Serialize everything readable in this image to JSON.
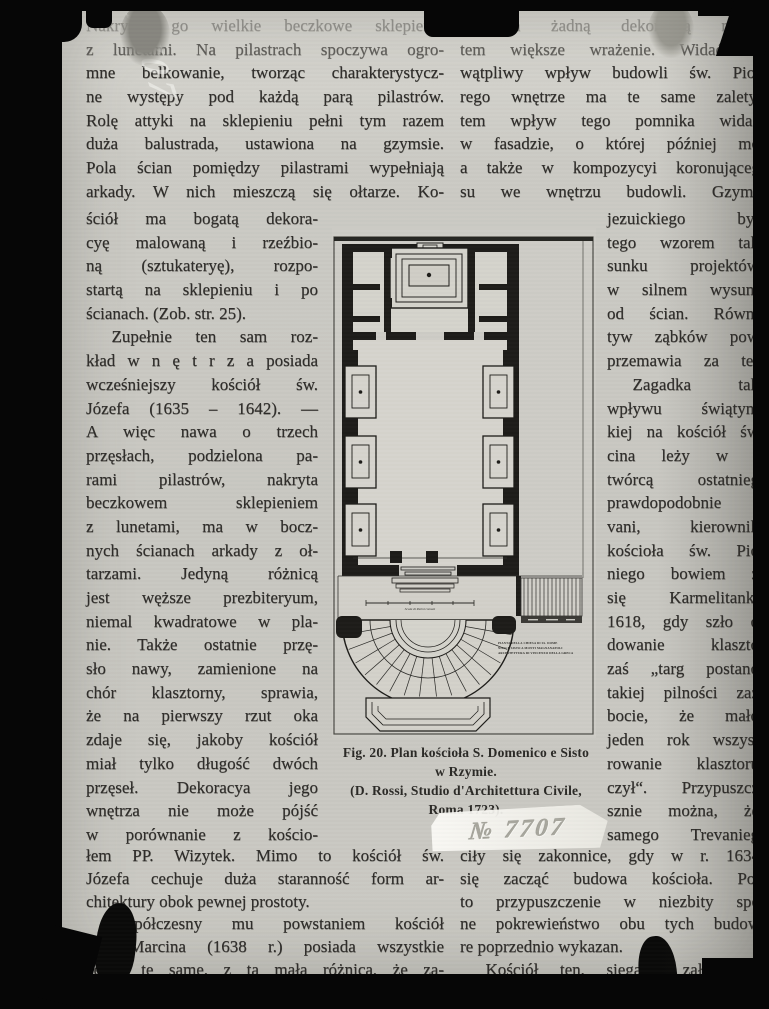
{
  "page": {
    "stamp_number": "№ 7707",
    "handwriting_number": "7707"
  },
  "left_column": {
    "top_lines": [
      {
        "t": "Nakrywa go wielkie beczkowe sklepienie",
        "c": "faded"
      },
      {
        "t": "z lunetami. Na pilastrach spoczywa ogro-",
        "c": "dim"
      },
      {
        "t": "mne belkowanie, tworząc charakterystycz-"
      },
      {
        "t": "ne występy pod każdą parą pilastrów."
      },
      {
        "t": "Rolę attyki na sklepieniu pełni tym razem"
      },
      {
        "t": "duża balustrada, ustawiona na gzymsie."
      },
      {
        "t": "Pola ścian pomiędzy pilastrami wypełniają"
      },
      {
        "t": "arkady. W nich mieszczą się ołtarze. Ko-"
      }
    ],
    "narrow_lines": [
      {
        "t": "ściół ma bogatą dekora-"
      },
      {
        "t": "cyę malowaną i rzeźbio-"
      },
      {
        "t": "ną (sztukateryę), rozpo-"
      },
      {
        "t": "startą na sklepieniu i po"
      },
      {
        "t": "ścianach. (Zob. str. 25).",
        "c": "end"
      },
      {
        "t": "Zupełnie ten sam roz-",
        "c": "indent"
      },
      {
        "t": "kład w n ę t r z a posiada"
      },
      {
        "t": "wcześniejszy kościół św."
      },
      {
        "t": "Józefa (1635 – 1642). —"
      },
      {
        "t": "A więc nawa o trzech"
      },
      {
        "t": "przęsłach, podzielona pa-"
      },
      {
        "t": "rami pilastrów, nakryta"
      },
      {
        "t": "beczkowem sklepieniem"
      },
      {
        "t": "z lunetami, ma w bocz-"
      },
      {
        "t": "nych ścianach arkady z oł-"
      },
      {
        "t": "tarzami. Jedyną różnicą"
      },
      {
        "t": "jest węższe prezbiteryum,"
      },
      {
        "t": "niemal kwadratowe w pla-"
      },
      {
        "t": "nie. Także ostatnie przę-"
      },
      {
        "t": "sło nawy, zamienione na"
      },
      {
        "t": "chór klasztorny, sprawia,"
      },
      {
        "t": "że na pierwszy rzut oka"
      },
      {
        "t": "zdaje się, jakoby kościół"
      },
      {
        "t": "miał tylko długość dwóch"
      },
      {
        "t": "przęseł. Dekoracya jego"
      },
      {
        "t": "wnętrza nie może pójść"
      },
      {
        "t": "w porównanie z kościo-"
      }
    ],
    "bottom_lines": [
      {
        "t": "łem PP. Wizytek. Mimo to kościół św."
      },
      {
        "t": "Józefa cechuje duża staranność form ar-"
      },
      {
        "t": "chitektury obok pewnej prostoty.",
        "c": "end"
      },
      {
        "t": "Współczesny mu powstaniem kościół",
        "c": "indent"
      },
      {
        "t": "św. Marcina (1638 r.) posiada wszystkie"
      },
      {
        "t": "cechy te same, z tą małą różnicą, że za-"
      }
    ]
  },
  "right_column": {
    "top_lines": [
      {
        "t": "tłumiona żadną dekoracyą malar",
        "c": "faded"
      },
      {
        "t": "tem większe wrażenie. Widać w",
        "c": "dim"
      },
      {
        "t": "wątpliwy wpływ budowli św. Piot"
      },
      {
        "t": "rego wnętrze ma te same zalety."
      },
      {
        "t": "tem wpływ tego pomnika widać"
      },
      {
        "t": "w fasadzie, o której później mó"
      },
      {
        "t": "a także w kompozycyi koronująceg"
      },
      {
        "t": "su we wnętrzu budowli. Gzyms"
      }
    ],
    "narrow_lines": [
      {
        "t": "jezuickiego był"
      },
      {
        "t": "tego wzorem tak"
      },
      {
        "t": "sunku projektów"
      },
      {
        "t": "w silnem wysuni"
      },
      {
        "t": "od ścian. Równi"
      },
      {
        "t": "tyw ząbków pow"
      },
      {
        "t": "przemawia za ter"
      },
      {
        "t": "Zagadka tak",
        "c": "indent"
      },
      {
        "t": "wpływu świątyni"
      },
      {
        "t": "kiej na kościół św"
      },
      {
        "t": "cina leży w t"
      },
      {
        "t": "twórcą ostatnieg"
      },
      {
        "t": "prawdopodobnie"
      },
      {
        "t": "vani, kierownik"
      },
      {
        "t": "kościoła św. Pio"
      },
      {
        "t": "niego bowiem ż"
      },
      {
        "t": "się Karmelitanki"
      },
      {
        "t": "1618, gdy szło o"
      },
      {
        "t": "dowanie klaszto"
      },
      {
        "t": "zaś „targ postano"
      },
      {
        "t": "takiej pilności zaż"
      },
      {
        "t": "bocie, że mało"
      },
      {
        "t": "jeden rok wszyst"
      },
      {
        "t": "rowanie klasztoru"
      },
      {
        "t": "czył“. Przypuszcz"
      },
      {
        "t": "sznie można, że"
      },
      {
        "t": "samego Trevanieg"
      }
    ],
    "bottom_lines": [
      {
        "t": "ciły się zakonnice, gdy w r. 1634"
      },
      {
        "t": "się zacząć budowa kościoła. Pot"
      },
      {
        "t": "to przypuszczenie w niezbity spo"
      },
      {
        "t": "ne pokrewieństwo obu tych budow"
      },
      {
        "t": "re poprzednio wykazan.",
        "c": "end"
      },
      {
        "t": "Kościół ten, sięgając założeniem",
        "c": "indent"
      }
    ]
  },
  "figure": {
    "caption_lines": [
      "Fig. 20. Plan kościoła S. Domenico e Sisto",
      "w Rzymie.",
      "(D. Rossi, Studio d'Architettura Civile,",
      "Roma 1723)."
    ],
    "plan_label_lines": [
      "PIANTA DELLA CHIESA DI SS. DOME",
      "NICO E SISTO A MONTI MAGNANAPOLI",
      "ARCHITETTURA DI VINCENZO DELLA GRECA"
    ],
    "scale_label": "Scala di Palmi romani"
  }
}
